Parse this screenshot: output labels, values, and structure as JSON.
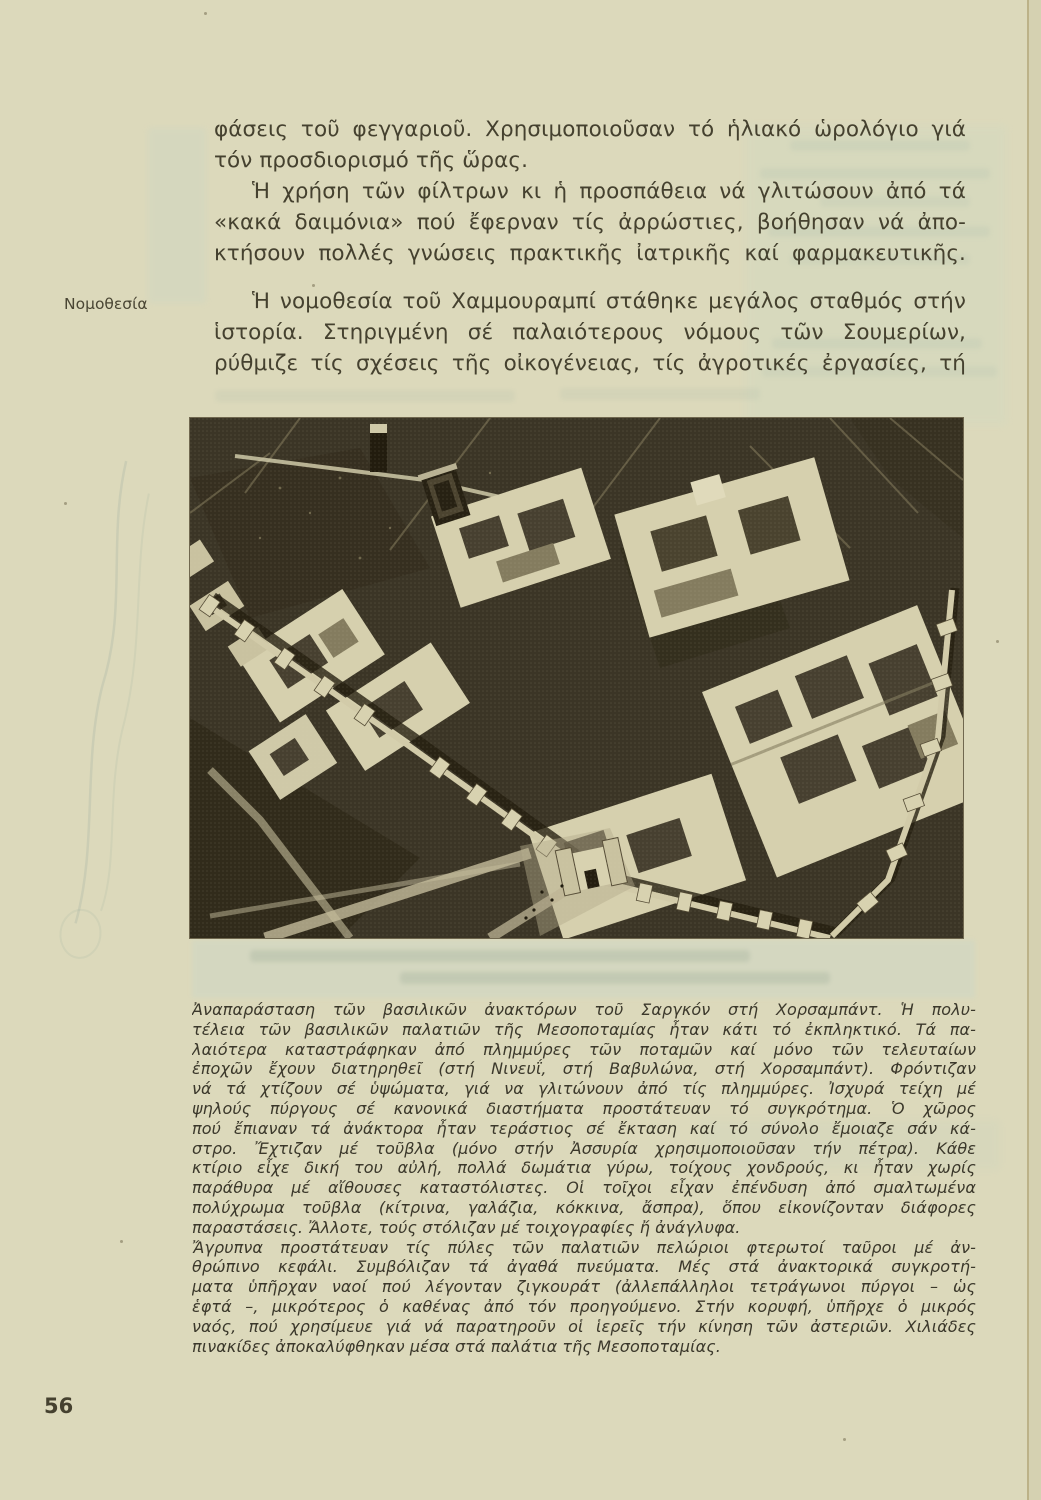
{
  "colors": {
    "paper": "#dcd9bb",
    "ink": "#45412f",
    "caption_ink": "#3b382b",
    "photo_dark": "#3b3526",
    "photo_light": "#d6d0ae",
    "page_edge": "#b2a477"
  },
  "content": {
    "body_lines": [
      {
        "text": "φάσεις τοῦ φεγγαριοῦ. Χρησιμοποιοῦσαν τό ἡλιακό ὡρολόγιο γιά",
        "justify": true
      },
      {
        "text": "τόν προσδιορισμό τῆς ὥρας.",
        "justify": false
      },
      {
        "text": "Ἡ χρήση τῶν φίλτρων κι ἡ προσπάθεια νά γλιτώσουν ἀπό τά",
        "indent": true,
        "justify": true
      },
      {
        "text": "«κακά δαιμόνια» πού ἔφερναν τίς ἀρρώστιες, βοήθησαν νά ἀπο-",
        "justify": true
      },
      {
        "text": "κτήσουν πολλές γνώσεις πρακτικῆς ἰατρικῆς καί φαρμακευτικῆς.",
        "justify": true
      }
    ],
    "margin_label": "Νομοθεσία",
    "law_lines": [
      {
        "text": "Ἡ νομοθεσία τοῦ Χαμμουραμπί στάθηκε μεγάλος σταθμός στήν",
        "indent": true,
        "justify": true
      },
      {
        "text": "ἱστορία. Στηριγμένη σέ παλαιότερους νόμους τῶν Σουμερίων,",
        "justify": true
      },
      {
        "text": "ρύθμιζε τίς σχέσεις τῆς οἰκογένειας, τίς ἀγροτικές ἐργασίες, τή συν-",
        "justify": true
      }
    ],
    "caption_lines": [
      {
        "text": "Ἀναπαράσταση τῶν βασιλικῶν ἀνακτόρων τοῦ Σαργκόν στή Χορσαμπάντ. Ἡ πολυ-",
        "justify": true
      },
      {
        "text": "τέλεια τῶν βασιλικῶν παλατιῶν τῆς Μεσοποταμίας ἦταν κάτι τό ἐκπληκτικό. Τά πα-",
        "justify": true
      },
      {
        "text": "λαιότερα καταστράφηκαν ἀπό πλημμύρες τῶν ποταμῶν καί μόνο τῶν τελευταίων",
        "justify": true
      },
      {
        "text": "ἐποχῶν ἔχουν διατηρηθεῖ (στή Νινευΐ, στή Βαβυλώνα, στή Χορσαμπάντ). Φρόντιζαν",
        "justify": true
      },
      {
        "text": "νά τά χτίζουν σέ ὑψώματα, γιά να γλιτώνουν ἀπό τίς πλημμύρες. Ἰσχυρά τείχη μέ",
        "justify": true
      },
      {
        "text": "ψηλούς πύργους σέ κανονικά διαστήματα προστάτευαν τό συγκρότημα. Ὁ χῶρος",
        "justify": true
      },
      {
        "text": "πού ἔπιαναν τά ἀνάκτορα ἦταν τεράστιος σέ ἔκταση καί τό σύνολο ἔμοιαζε σάν κά-",
        "justify": true
      },
      {
        "text": "στρο. Ἔχτιζαν μέ τοῦβλα (μόνο στήν Ἀσσυρία χρησιμοποιοῦσαν τήν πέτρα). Κάθε",
        "justify": true
      },
      {
        "text": "κτίριο εἶχε δική του αὐλή, πολλά δωμάτια γύρω, τοίχους χονδρούς, κι ἦταν χωρίς",
        "justify": true
      },
      {
        "text": "παράθυρα μέ αἴθουσες καταστόλιστες. Οἱ τοῖχοι εἶχαν ἐπένδυση ἀπό σμαλτωμένα",
        "justify": true
      },
      {
        "text": "πολύχρωμα τοῦβλα (κίτρινα, γαλάζια, κόκκινα, ἄσπρα), ὅπου εἰκονίζονταν διάφορες",
        "justify": true
      },
      {
        "text": "παραστάσεις. Ἄλλοτε, τούς στόλιζαν μέ τοιχογραφίες ἤ ἀνάγλυφα.",
        "justify": false
      },
      {
        "text": "Ἄγρυπνα προστάτευαν τίς πύλες τῶν παλατιῶν πελώριοι φτερωτοί ταῦροι μέ ἀν-",
        "justify": true
      },
      {
        "text": "θρώπινο κεφάλι. Συμβόλιζαν τά ἀγαθά πνεύματα. Μές στά ἀνακτορικά συγκροτή-",
        "justify": true
      },
      {
        "text": "ματα ὑπῆρχαν ναοί πού λέγονταν ζιγκουράτ (ἀλλεπάλληλοι τετράγωνοι πύργοι – ὡς",
        "justify": true
      },
      {
        "text": "ἑφτά –, μικρότερος ὁ καθένας ἀπό τόν προηγούμενο. Στήν κορυφή, ὑπῆρχε ὁ μικρός",
        "justify": true
      },
      {
        "text": "ναός, πού χρησίμευε γιά νά παρατηροῦν οἱ ἱερεῖς τήν κίνηση τῶν ἀστεριῶν. Χιλιάδες",
        "justify": true
      },
      {
        "text": "πινακίδες ἀποκαλύφθηκαν μέσα στά παλάτια τῆς Μεσοποταμίας.",
        "justify": false
      }
    ],
    "page_number": "56"
  }
}
